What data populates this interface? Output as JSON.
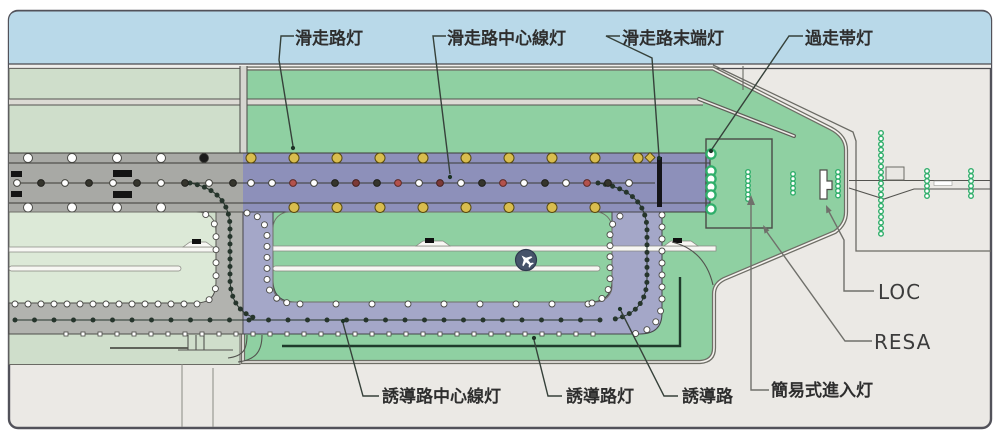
{
  "diagram": {
    "labels": {
      "runway_edge_lights": "滑走路灯",
      "runway_centerline_lights": "滑走路中心線灯",
      "runway_end_lights": "滑走路末端灯",
      "overrun_area_lights": "過走帯灯",
      "taxiway_centerline_lights": "誘導路中心線灯",
      "taxiway_edge_lights": "誘導路灯",
      "taxiway": "誘導路",
      "simple_approach_lights": "簡易式進入灯",
      "localizer": "LOC",
      "resa": "RESA"
    },
    "colors": {
      "sky": "#b9d9e9",
      "card_bg": "#ebe9e5",
      "grass_green": "#8fd0a2",
      "pale_green": "#cfdecb",
      "pale_interior": "#dce9d7",
      "runway_purple": "#8d90ba",
      "runway_gray": "#a8a9a5",
      "taxiway_purple": "#a4a7c8",
      "taxiway_gray": "#b2b3af",
      "edge_yellow": "#d9bd4e",
      "edge_yellow_rim": "#57490f",
      "light_white": "#ffffff",
      "light_rim": "#4a4a46",
      "centerline_white": "#ffffff",
      "centerline_dark": "#35352d",
      "centerline_red": "#b3524c",
      "centerline_darkred": "#7c3a38",
      "approach_green": "#2fae6a",
      "chain_green": "#26352c",
      "border": "#52525a"
    },
    "lights": {
      "presets": {
        "edge": {
          "r": 3.0,
          "kind": "circle",
          "fill": "#ffffff",
          "stroke": "#4a4a46",
          "sw": 0.9
        },
        "square": {
          "r": 2.0,
          "kind": "square",
          "fill": "#ffffff",
          "stroke": "#4a4a46",
          "sw": 0.8
        },
        "chain": {
          "r": 2.5,
          "kind": "circle",
          "fill": "#26352c",
          "stroke": "none",
          "sw": 0
        }
      },
      "runway_edge_top_yellow_xs": [
        251,
        294,
        337,
        380,
        423,
        466,
        509,
        552,
        595,
        638
      ],
      "runway_edge_bottom_yellow_xs": [
        294,
        337,
        380,
        423,
        466,
        509,
        552,
        595
      ],
      "runway_edge_top_white_xs": [
        28,
        72,
        117,
        161
      ],
      "runway_edge_bottom_white_xs": [
        28,
        72,
        117,
        161
      ],
      "runway_edge_top_y": 158,
      "runway_edge_bottom_y": 207.5,
      "runway_centerline_y": 183,
      "runway_centerline_gray": [
        {
          "x": 17,
          "c": "w"
        },
        {
          "x": 41,
          "c": "d"
        },
        {
          "x": 65,
          "c": "w"
        },
        {
          "x": 89,
          "c": "d"
        },
        {
          "x": 113,
          "c": "w"
        },
        {
          "x": 137,
          "c": "d"
        },
        {
          "x": 161,
          "c": "w"
        },
        {
          "x": 185,
          "c": "d"
        },
        {
          "x": 209,
          "c": "w"
        },
        {
          "x": 233,
          "c": "d"
        }
      ],
      "runway_centerline_colored": [
        {
          "x": 251,
          "c": "w"
        },
        {
          "x": 272,
          "c": "w"
        },
        {
          "x": 293,
          "c": "r"
        },
        {
          "x": 314,
          "c": "w"
        },
        {
          "x": 335,
          "c": "d"
        },
        {
          "x": 356,
          "c": "dr"
        },
        {
          "x": 377,
          "c": "d"
        },
        {
          "x": 398,
          "c": "r"
        },
        {
          "x": 419,
          "c": "w"
        },
        {
          "x": 440,
          "c": "dr"
        },
        {
          "x": 461,
          "c": "w"
        },
        {
          "x": 482,
          "c": "d"
        },
        {
          "x": 503,
          "c": "r"
        },
        {
          "x": 524,
          "c": "w"
        },
        {
          "x": 545,
          "c": "d"
        },
        {
          "x": 566,
          "c": "w"
        },
        {
          "x": 587,
          "c": "r"
        },
        {
          "x": 608,
          "c": "d"
        },
        {
          "x": 629,
          "c": "w"
        }
      ],
      "overrun_column": {
        "x": 711,
        "ys": [
          154,
          171,
          179,
          187,
          195,
          209
        ],
        "r": 4.6,
        "sw": 2.3
      },
      "approach_columns": [
        {
          "x": 748,
          "y0": 172,
          "n": 7,
          "dy": 4.5
        },
        {
          "x": 793,
          "y0": 174,
          "n": 5,
          "dy": 4.7
        },
        {
          "x": 838,
          "y0": 172,
          "n": 6,
          "dy": 4.7
        },
        {
          "x": 881,
          "y0": 133,
          "n": 19,
          "dy": 5.6
        },
        {
          "x": 927,
          "y0": 171,
          "n": 6,
          "dy": 5.0
        },
        {
          "x": 971,
          "y0": 171,
          "n": 6,
          "dy": 5.0
        }
      ],
      "approach_dot": {
        "r": 2.3,
        "sw": 1.4
      }
    }
  }
}
